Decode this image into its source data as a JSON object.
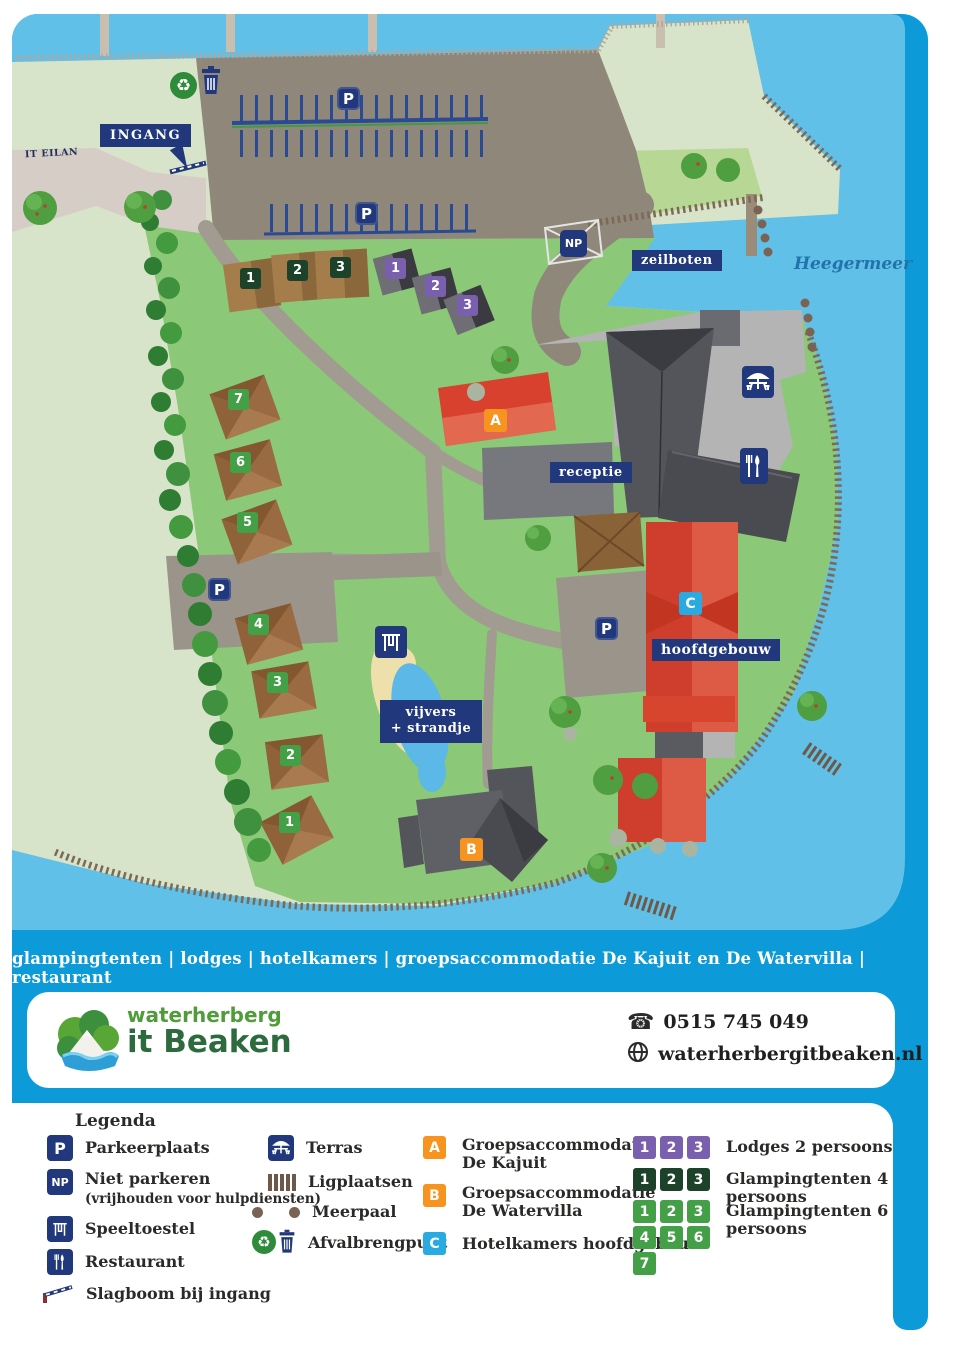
{
  "map": {
    "labels": {
      "it_eilan": "IT EILAN",
      "ingang": "INGANG",
      "parking": "P",
      "np": "NP",
      "zeilboten": "zeilboten",
      "heegermeer": "Heegermeer",
      "receptie": "receptie",
      "hoofdgebouw": "hoofdgebouw",
      "vijvers_line1": "vijvers",
      "vijvers_line2": "+ strandje"
    },
    "badges": {
      "a": "A",
      "b": "B",
      "c": "C"
    },
    "glamp6_numbers": [
      "1",
      "2",
      "3",
      "4",
      "5",
      "6",
      "7"
    ],
    "glamp4_numbers": [
      "1",
      "2",
      "3"
    ],
    "lodge_numbers": [
      "1",
      "2",
      "3"
    ]
  },
  "tagline": "glampingtenten | lodges | hotelkamers | groepsaccommodatie De Kajuit en De Watervilla | restaurant",
  "brand": {
    "line1": "waterherberg",
    "line2": "it Beaken"
  },
  "contact": {
    "phone": "0515 745 049",
    "website": "waterherbergitbeaken.nl"
  },
  "legend": {
    "title": "Legenda",
    "col1": [
      {
        "icon": "parking-icon",
        "label": "Parkeerplaats"
      },
      {
        "icon": "no-parking-icon",
        "label": "Niet parkeren",
        "sub": "(vrijhouden voor hulpdiensten)"
      },
      {
        "icon": "playground-icon",
        "label": "Speeltoestel"
      },
      {
        "icon": "restaurant-icon",
        "label": "Restaurant"
      },
      {
        "icon": "barrier-icon",
        "label": "Slagboom bij ingang"
      }
    ],
    "col2": [
      {
        "icon": "terrace-icon",
        "label": "Terras"
      },
      {
        "icon": "berths-icon",
        "label": "Ligplaatsen"
      },
      {
        "icon": "mooring-icon",
        "label": "Meerpaal"
      },
      {
        "icon": "waste-icon",
        "label": "Afvalbrengpunt"
      }
    ],
    "col3": [
      {
        "badge": "A",
        "line1": "Groepsaccommodatie",
        "line2": "De Kajuit"
      },
      {
        "badge": "B",
        "line1": "Groepsaccommodatie",
        "line2": "De Watervilla"
      },
      {
        "badge": "C",
        "line1": "Hotelkamers hoofdgebouw"
      }
    ],
    "col4": [
      {
        "numbers": [
          "1",
          "2",
          "3"
        ],
        "label": "Lodges 2 persoons"
      },
      {
        "numbers": [
          "1",
          "2",
          "3"
        ],
        "label": "Glampingtenten 4 persoons"
      },
      {
        "numbers": [
          "1",
          "2",
          "3",
          "4",
          "5",
          "6",
          "7"
        ],
        "label": "Glampingtenten 6 persoons"
      }
    ]
  },
  "colors": {
    "frame_blue": "#0c9bd8",
    "lake_blue": "#60c0e8",
    "navy": "#21397c",
    "orange_badge": "#f79420",
    "c_badge_blue": "#29abe2",
    "lodge_purple": "#7a5fae",
    "glamp4_green": "#1c432a",
    "glamp6_green": "#43a047",
    "site_green": "#8bc877",
    "building_red": "#d8412e",
    "brand_green": "#4e9d39",
    "brand_dark_green": "#2d6b3f"
  }
}
